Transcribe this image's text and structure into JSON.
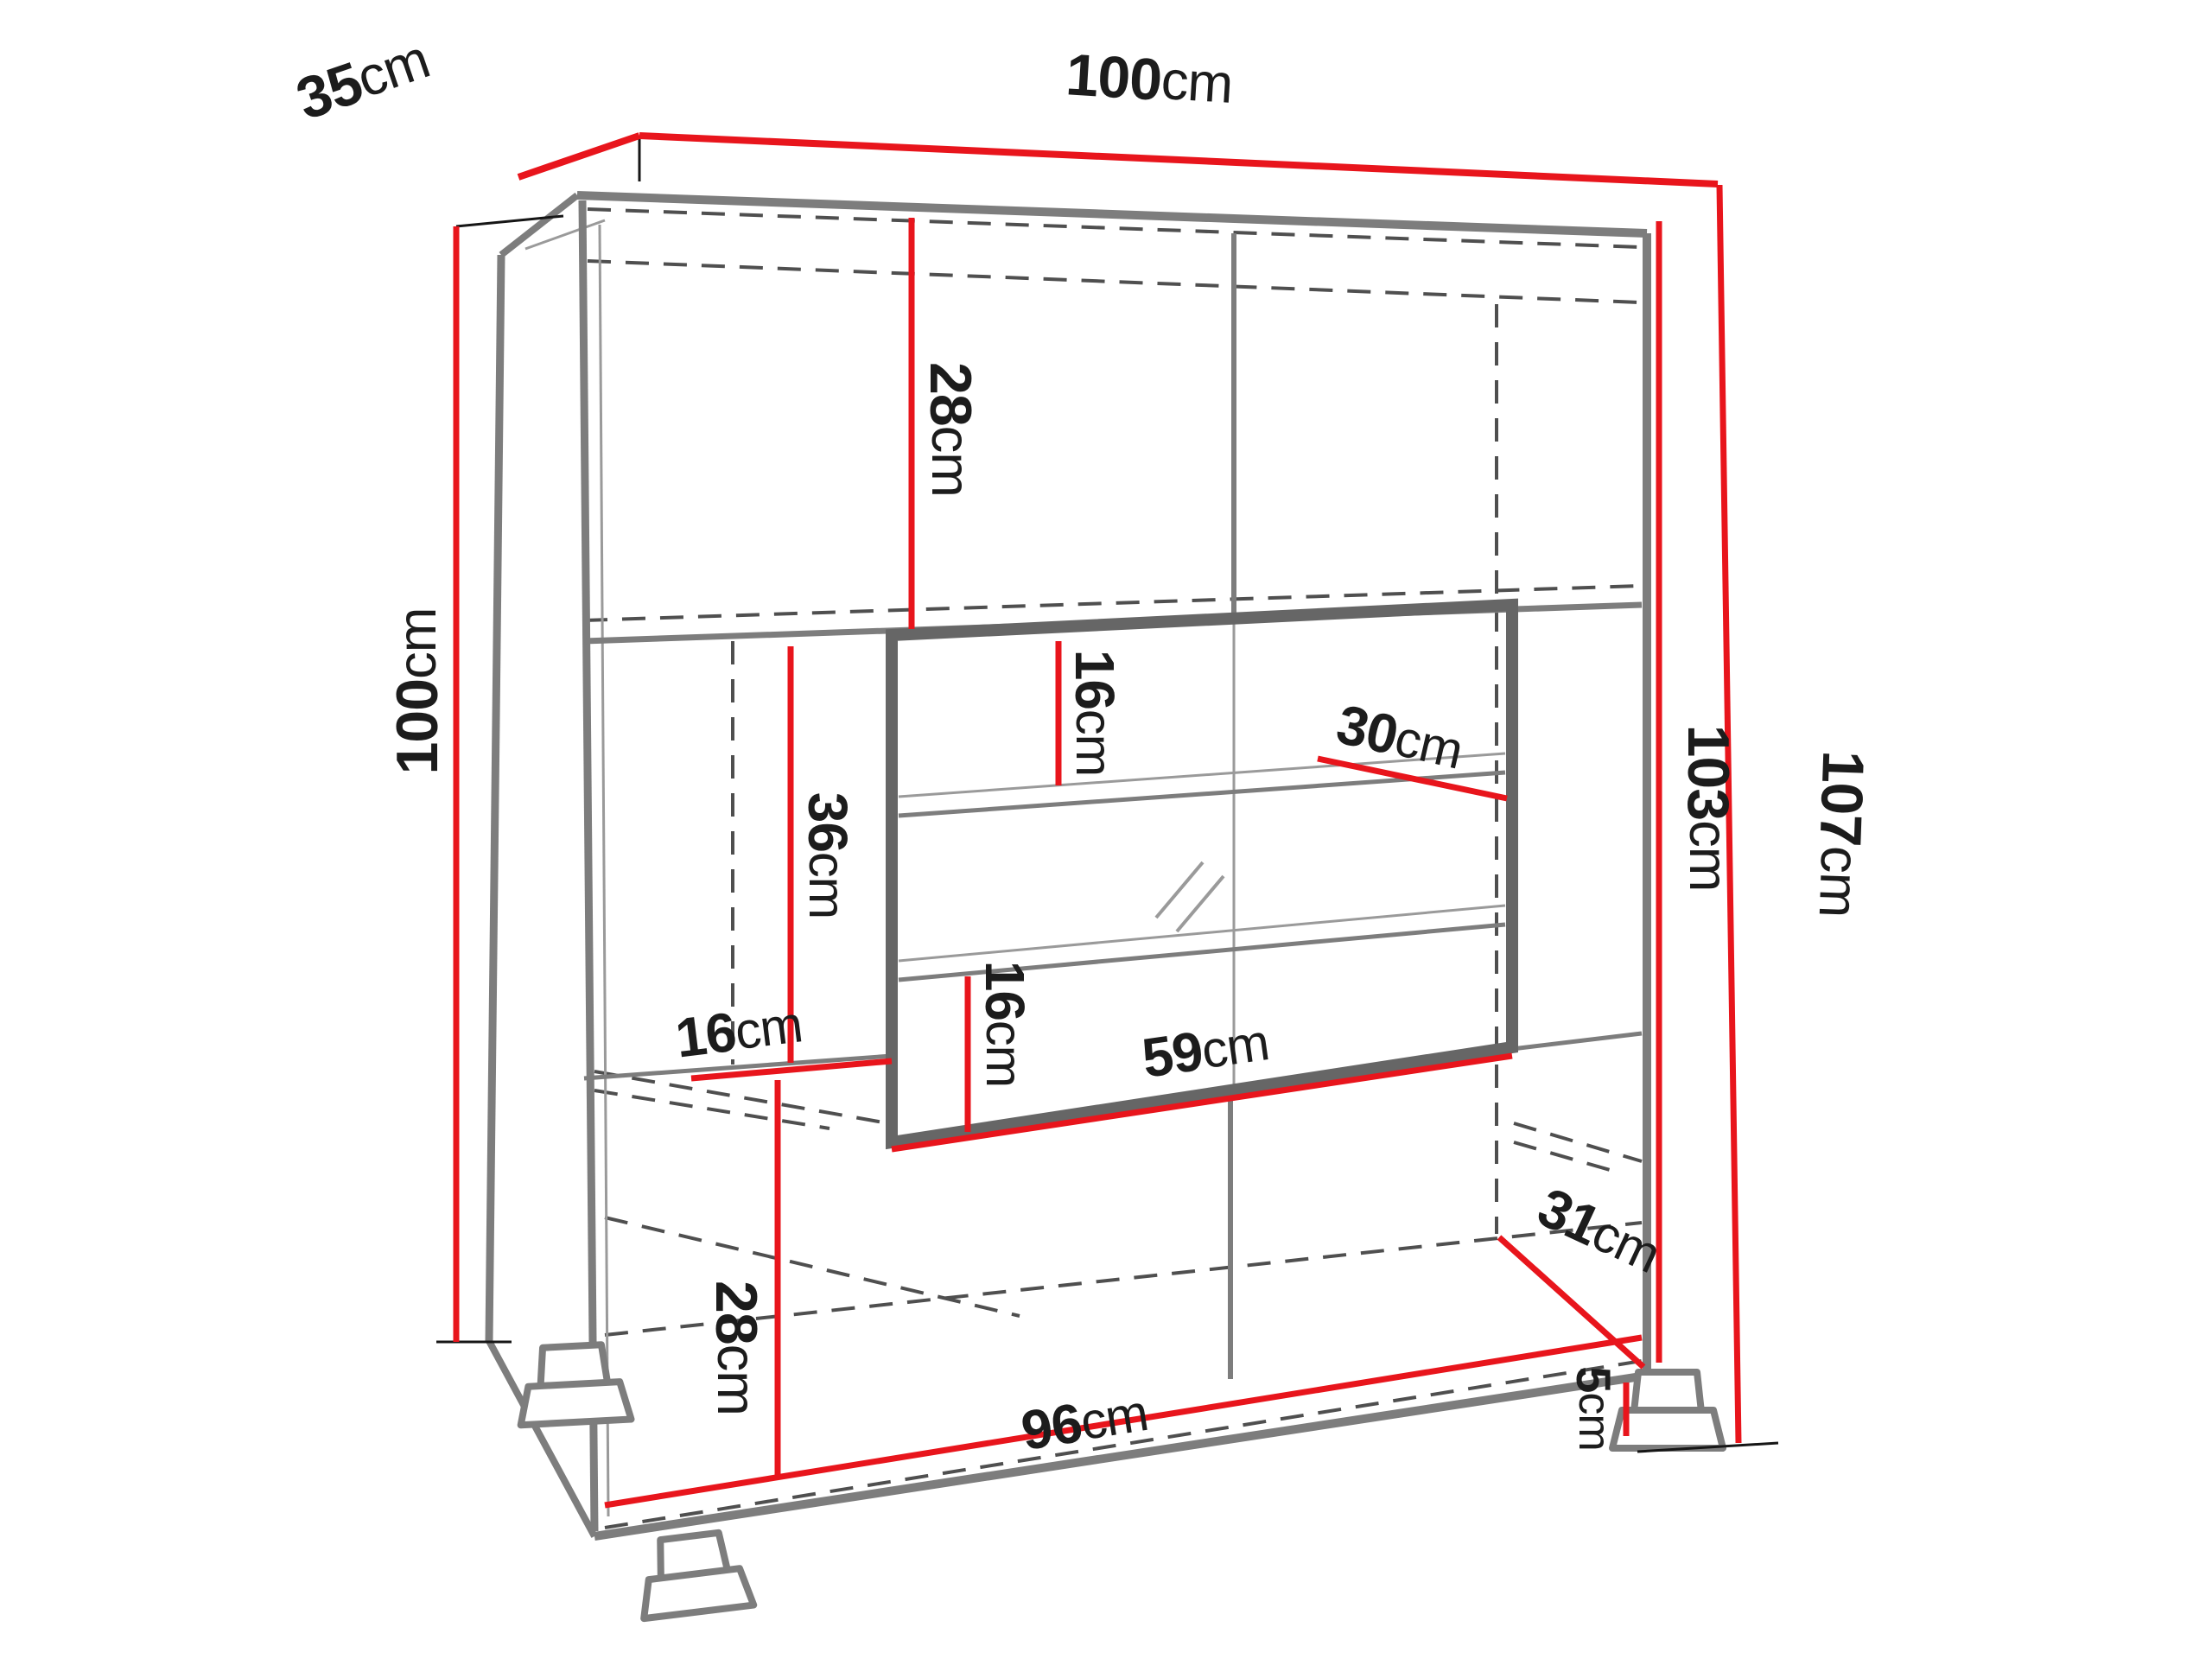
{
  "diagram": {
    "kind": "furniture-dimension-diagram",
    "subject": "display cabinet with glass showcase, perspective line drawing with red dimension lines",
    "unit": "cm",
    "colors": {
      "accent": "#e8151c",
      "structure": "#7d7d7d",
      "hidden_edges": "#4f4f4f",
      "text": "#1c1c1c",
      "background": "#ffffff"
    },
    "labels": [
      {
        "id": "top-depth",
        "value": "35",
        "unit": "cm"
      },
      {
        "id": "top-width",
        "value": "100",
        "unit": "cm"
      },
      {
        "id": "left-height",
        "value": "100",
        "unit": "cm"
      },
      {
        "id": "upper-compartment-height",
        "value": "28",
        "unit": "cm"
      },
      {
        "id": "showcase-upper-gap",
        "value": "16",
        "unit": "cm"
      },
      {
        "id": "showcase-shelf-depth",
        "value": "30",
        "unit": "cm"
      },
      {
        "id": "showcase-left-height",
        "value": "36",
        "unit": "cm"
      },
      {
        "id": "showcase-lower-gap",
        "value": "16",
        "unit": "cm"
      },
      {
        "id": "left-opening-width",
        "value": "16",
        "unit": "cm"
      },
      {
        "id": "showcase-width",
        "value": "59",
        "unit": "cm"
      },
      {
        "id": "body-height-right",
        "value": "103",
        "unit": "cm"
      },
      {
        "id": "total-height-right",
        "value": "107",
        "unit": "cm"
      },
      {
        "id": "lower-compartment-height",
        "value": "28",
        "unit": "cm"
      },
      {
        "id": "bottom-width",
        "value": "96",
        "unit": "cm"
      },
      {
        "id": "bottom-depth",
        "value": "31",
        "unit": "cm"
      },
      {
        "id": "foot-height",
        "value": "5",
        "unit": "cm"
      }
    ]
  }
}
